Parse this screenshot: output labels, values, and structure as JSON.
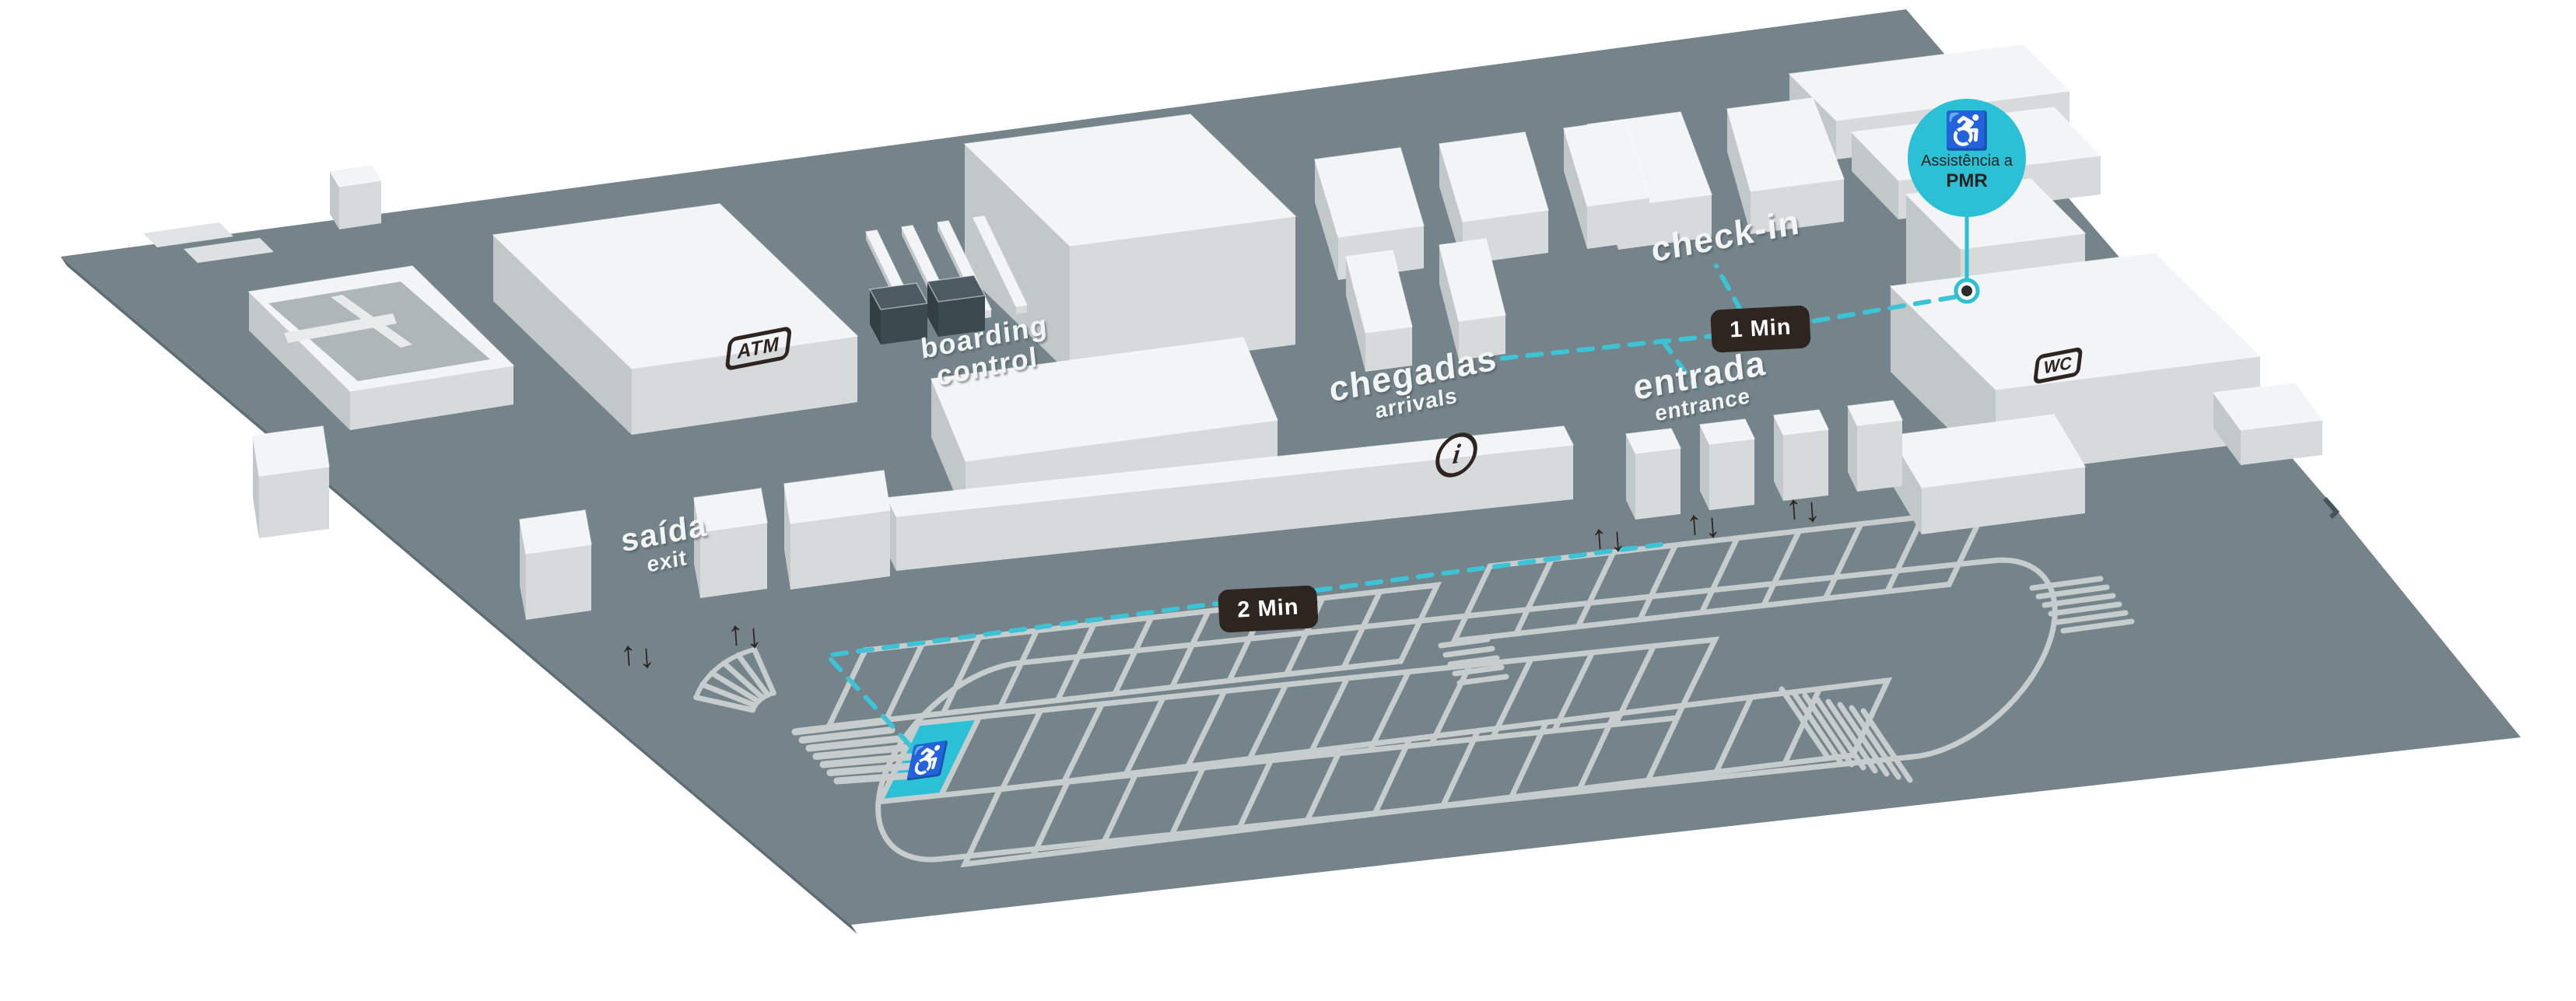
{
  "map": {
    "labels": {
      "saida": {
        "primary": "saída",
        "secondary": "exit"
      },
      "boarding": {
        "line1": "boarding",
        "line2": "control"
      },
      "chegadas": {
        "primary": "chegadas",
        "secondary": "arrivals"
      },
      "entrada": {
        "primary": "entrada",
        "secondary": "entrance"
      },
      "check_in": "check-in"
    },
    "route_badges": {
      "segment1": "1 Min",
      "segment2": "2 Min"
    },
    "poi_pin": {
      "icon": "♿",
      "line1": "Assistência a",
      "line2": "PMR"
    },
    "amenity_icons": {
      "atm": "ATM",
      "wc": "WC",
      "info": "i"
    },
    "accessible_parking": {
      "icon": "♿"
    },
    "direction_arrows": {
      "up": "↑",
      "down": "↓"
    },
    "colors": {
      "ground": "#74848A",
      "ground_edge": "#5E6E74",
      "building_top": "#F3F4F5",
      "building_side_light": "#D7DADB",
      "building_side_dark": "#C2C7C8",
      "security_gate_dark": "#4C5B61",
      "parking_line": "#C7CCCD",
      "accent_cyan": "#2BC0D5",
      "route_dash_cyan": "#3CC3D6",
      "badge_dark": "#2E2520",
      "icon_dark": "#2E2520"
    }
  }
}
